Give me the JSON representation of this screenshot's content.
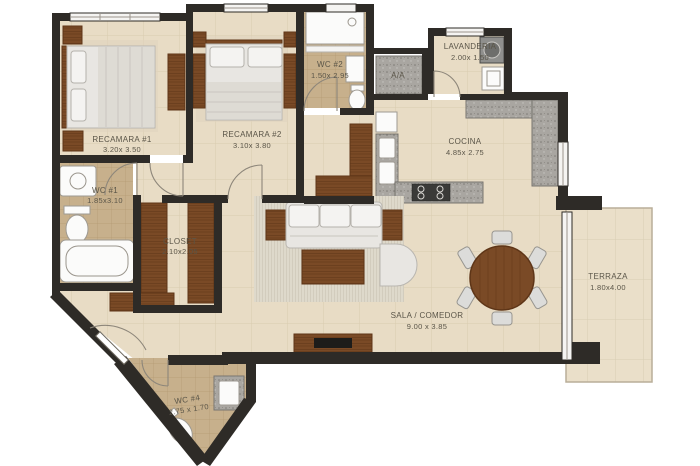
{
  "plan_title": "apartment floor plan",
  "colors": {
    "bg": "#ffffff",
    "wall": "#2e2b27",
    "floor": "#e8dcc5",
    "floor_line": "#d9cbb0",
    "bath_floor": "#c7b08c",
    "bath_line": "#b49a73",
    "granite": "#a9a6a1",
    "granite_dark": "#7d7a75",
    "wood": "#7a4a26",
    "wood_dark": "#5e3517",
    "fabric": "#e8e6e2",
    "fabric_edge": "#b9b6b0",
    "rug": "#ded9cb",
    "terraza_floor": "#eadfc9",
    "window": "#f5f4f2",
    "text": "#5a5548"
  },
  "rooms": {
    "recamara1": {
      "name": "RECAMARA #1",
      "dims": "3.20x 3.50"
    },
    "recamara2": {
      "name": "RECAMARA #2",
      "dims": "3.10x 3.80"
    },
    "wc2": {
      "name": "WC #2",
      "dims": "1.50x 2.95"
    },
    "aa": {
      "name": "A/A"
    },
    "lavanderia": {
      "name": "LAVANDERIA",
      "dims": "2.00x 1.50"
    },
    "cocina": {
      "name": "COCINA",
      "dims": "4.85x 2.75"
    },
    "wc1": {
      "name": "WC #1",
      "dims": "1.85x3.10"
    },
    "closet": {
      "name": "CLOSET",
      "dims": "2.10x2.05"
    },
    "sala_comedor": {
      "name": "SALA / COMEDOR",
      "dims": "9.00 x 3.85"
    },
    "terraza": {
      "name": "TERRAZA",
      "dims": "1.80x4.00"
    },
    "wc4": {
      "name": "WC #4",
      "dims": "2.75 x 1.70"
    }
  }
}
